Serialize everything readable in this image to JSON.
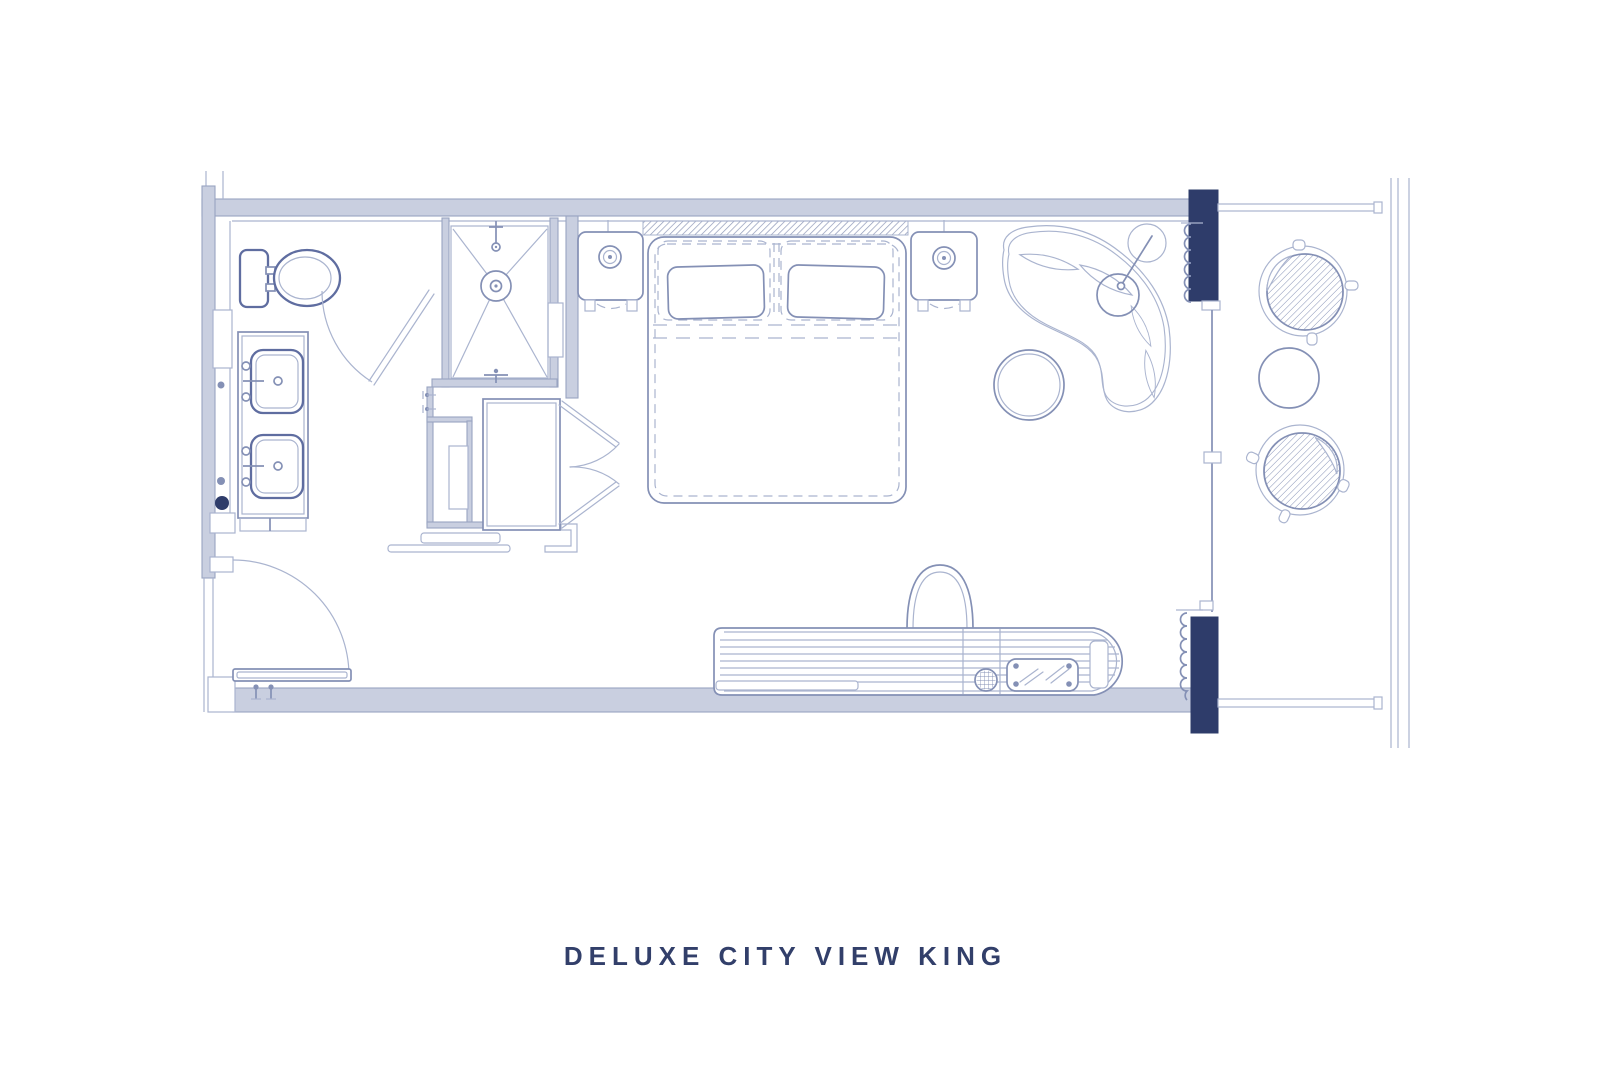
{
  "title": {
    "text": "DELUXE CITY VIEW KING"
  },
  "colors": {
    "navy": "#2e3c6a",
    "wall-fill": "#c9cfe0",
    "wall-edge": "#99a4c1",
    "line-light": "#aab4cf",
    "line-mid": "#8490b5",
    "line-dark": "#5f6da0",
    "hatch": "#8e99b8",
    "title-color": "#323f6a"
  },
  "plan": {
    "type": "hotel-room-floor-plan",
    "elements": [
      "toilet",
      "double-vanity",
      "shower",
      "bathroom-door",
      "wardrobe-closet",
      "luggage-bench",
      "entry-door",
      "king-bed",
      "headboard",
      "nightstand-left",
      "nightstand-right",
      "table-lamp-left",
      "table-lamp-right",
      "chaise-lounge",
      "floor-lamp",
      "side-table",
      "tv-console",
      "tv",
      "minibar-tray",
      "knob",
      "window-wall",
      "curtains",
      "balcony-rails",
      "balcony-chair-top",
      "balcony-chair-bottom",
      "balcony-table"
    ]
  }
}
